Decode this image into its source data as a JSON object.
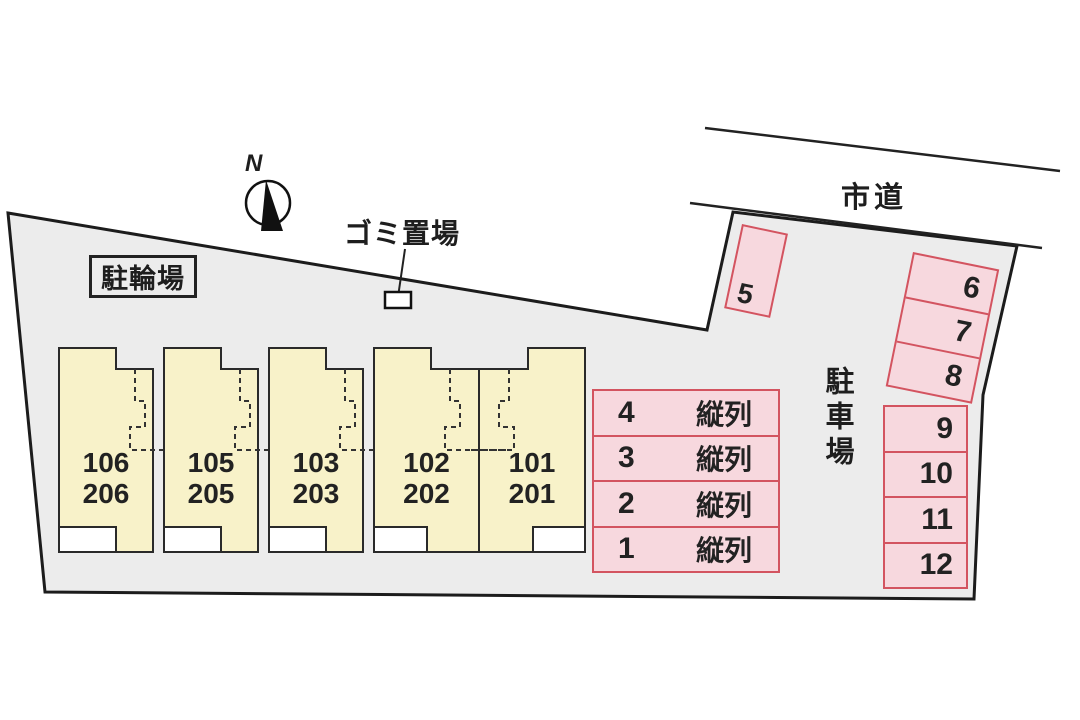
{
  "site": {
    "compass_label": "N",
    "road_label": "市道",
    "bicycle_parking_label": "駐輪場",
    "garbage_label": "ゴミ置場",
    "parking_lot_label": "駐車場"
  },
  "buildings": {
    "units": [
      {
        "line1": "106",
        "line2": "206"
      },
      {
        "line1": "105",
        "line2": "205"
      },
      {
        "line1": "103",
        "line2": "203"
      },
      {
        "line1": "102",
        "line2": "202"
      },
      {
        "line1": "101",
        "line2": "201"
      }
    ]
  },
  "parking": {
    "tandem_rows": [
      {
        "number": "4",
        "type": "縦列"
      },
      {
        "number": "3",
        "type": "縦列"
      },
      {
        "number": "2",
        "type": "縦列"
      },
      {
        "number": "1",
        "type": "縦列"
      }
    ],
    "space5": {
      "number": "5"
    },
    "tilted_rows": [
      {
        "number": "6"
      },
      {
        "number": "7"
      },
      {
        "number": "8"
      }
    ],
    "right_rows": [
      {
        "number": "9"
      },
      {
        "number": "10"
      },
      {
        "number": "11"
      },
      {
        "number": "12"
      }
    ]
  },
  "colors": {
    "property_fill": "#ececec",
    "building_fill": "#f8f2c9",
    "parking_fill": "#f7d8de",
    "parking_border": "#d35460",
    "outline": "#1c1c1c"
  }
}
